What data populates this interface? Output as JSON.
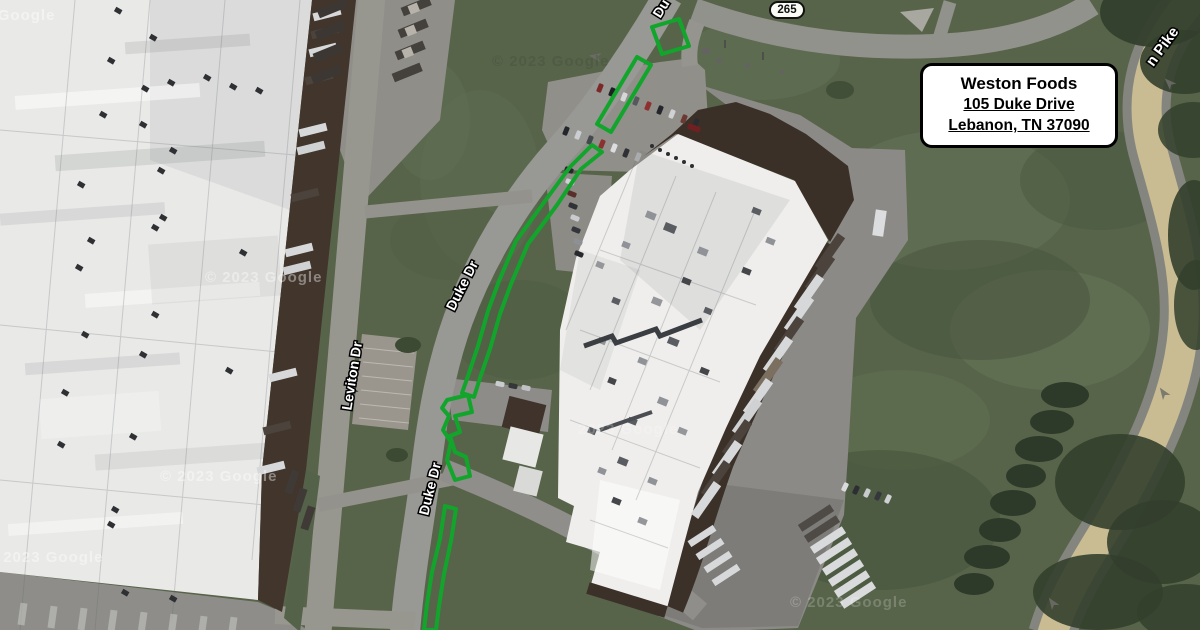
{
  "info_box": {
    "title": "Weston Foods",
    "address_line_1": "105 Duke Drive",
    "address_line_2": "Lebanon, TN 37090"
  },
  "route_shield": {
    "number": "265"
  },
  "colors": {
    "highlight_green": "#12a52b",
    "pike_pavement_tan": "#c9bc92",
    "grass_base": "#57644a"
  },
  "road_labels": [
    {
      "text": "Du",
      "x": 662,
      "y": 9,
      "rotation": -58,
      "size": 14
    },
    {
      "text": "Duke Dr",
      "x": 463,
      "y": 286,
      "rotation": -63,
      "size": 14
    },
    {
      "text": "Duke Dr",
      "x": 431,
      "y": 489,
      "rotation": -76,
      "size": 14
    },
    {
      "text": "Leviton Dr",
      "x": 353,
      "y": 376,
      "rotation": -81,
      "size": 14
    },
    {
      "text": "n Pike",
      "x": 1163,
      "y": 47,
      "rotation": -54,
      "size": 15
    }
  ],
  "watermarks": [
    {
      "text": "© 2023 Google",
      "x": -62,
      "y": 20,
      "opacity": 0.45,
      "color": "#ffffff"
    },
    {
      "text": "© 2023 Google",
      "x": 492,
      "y": 66,
      "opacity": 0.2,
      "color": "#3a3a30"
    },
    {
      "text": "© 2023 Google",
      "x": 205,
      "y": 282,
      "opacity": 0.4,
      "color": "#ffffff"
    },
    {
      "text": "© 2023 Google",
      "x": 160,
      "y": 481,
      "opacity": 0.4,
      "color": "#ffffff"
    },
    {
      "text": "© 2023 Google",
      "x": -14,
      "y": 562,
      "opacity": 0.4,
      "color": "#ffffff"
    },
    {
      "text": "2023 Google",
      "x": 578,
      "y": 434,
      "opacity": 0.22,
      "color": "#ffffff"
    },
    {
      "text": "© 2023 Google",
      "x": 790,
      "y": 607,
      "opacity": 0.2,
      "color": "#ffffff"
    }
  ],
  "highlights": {
    "label": "curbside-parking-highlight",
    "shapes": [
      {
        "name": "highlight-segment-1",
        "points": [
          [
            652,
            27
          ],
          [
            679,
            19
          ],
          [
            689,
            46
          ],
          [
            662,
            54
          ]
        ]
      },
      {
        "name": "highlight-segment-2",
        "points": [
          [
            637,
            57
          ],
          [
            651,
            65
          ],
          [
            611,
            132
          ],
          [
            597,
            124
          ]
        ]
      },
      {
        "name": "highlight-segment-3",
        "points": [
          [
            592,
            145
          ],
          [
            570,
            167
          ],
          [
            545,
            201
          ],
          [
            516,
            241
          ],
          [
            499,
            281
          ],
          [
            488,
            311
          ],
          [
            478,
            346
          ],
          [
            468,
            376
          ],
          [
            462,
            393
          ],
          [
            474,
            397
          ],
          [
            480,
            378
          ],
          [
            490,
            349
          ],
          [
            500,
            314
          ],
          [
            511,
            284
          ],
          [
            528,
            244
          ],
          [
            557,
            205
          ],
          [
            581,
            169
          ],
          [
            602,
            152
          ]
        ]
      },
      {
        "name": "highlight-segment-4",
        "points": [
          [
            447,
            400
          ],
          [
            468,
            395
          ],
          [
            472,
            412
          ],
          [
            455,
            416
          ],
          [
            460,
            432
          ],
          [
            450,
            436
          ],
          [
            455,
            452
          ],
          [
            466,
            457
          ],
          [
            470,
            476
          ],
          [
            455,
            480
          ],
          [
            447,
            460
          ],
          [
            451,
            442
          ],
          [
            443,
            430
          ],
          [
            449,
            416
          ],
          [
            442,
            408
          ]
        ]
      },
      {
        "name": "highlight-segment-5",
        "points": [
          [
            445,
            506
          ],
          [
            456,
            509
          ],
          [
            451,
            541
          ],
          [
            444,
            574
          ],
          [
            439,
            606
          ],
          [
            436,
            630
          ],
          [
            424,
            630
          ],
          [
            427,
            604
          ],
          [
            432,
            572
          ],
          [
            440,
            539
          ]
        ]
      }
    ]
  }
}
